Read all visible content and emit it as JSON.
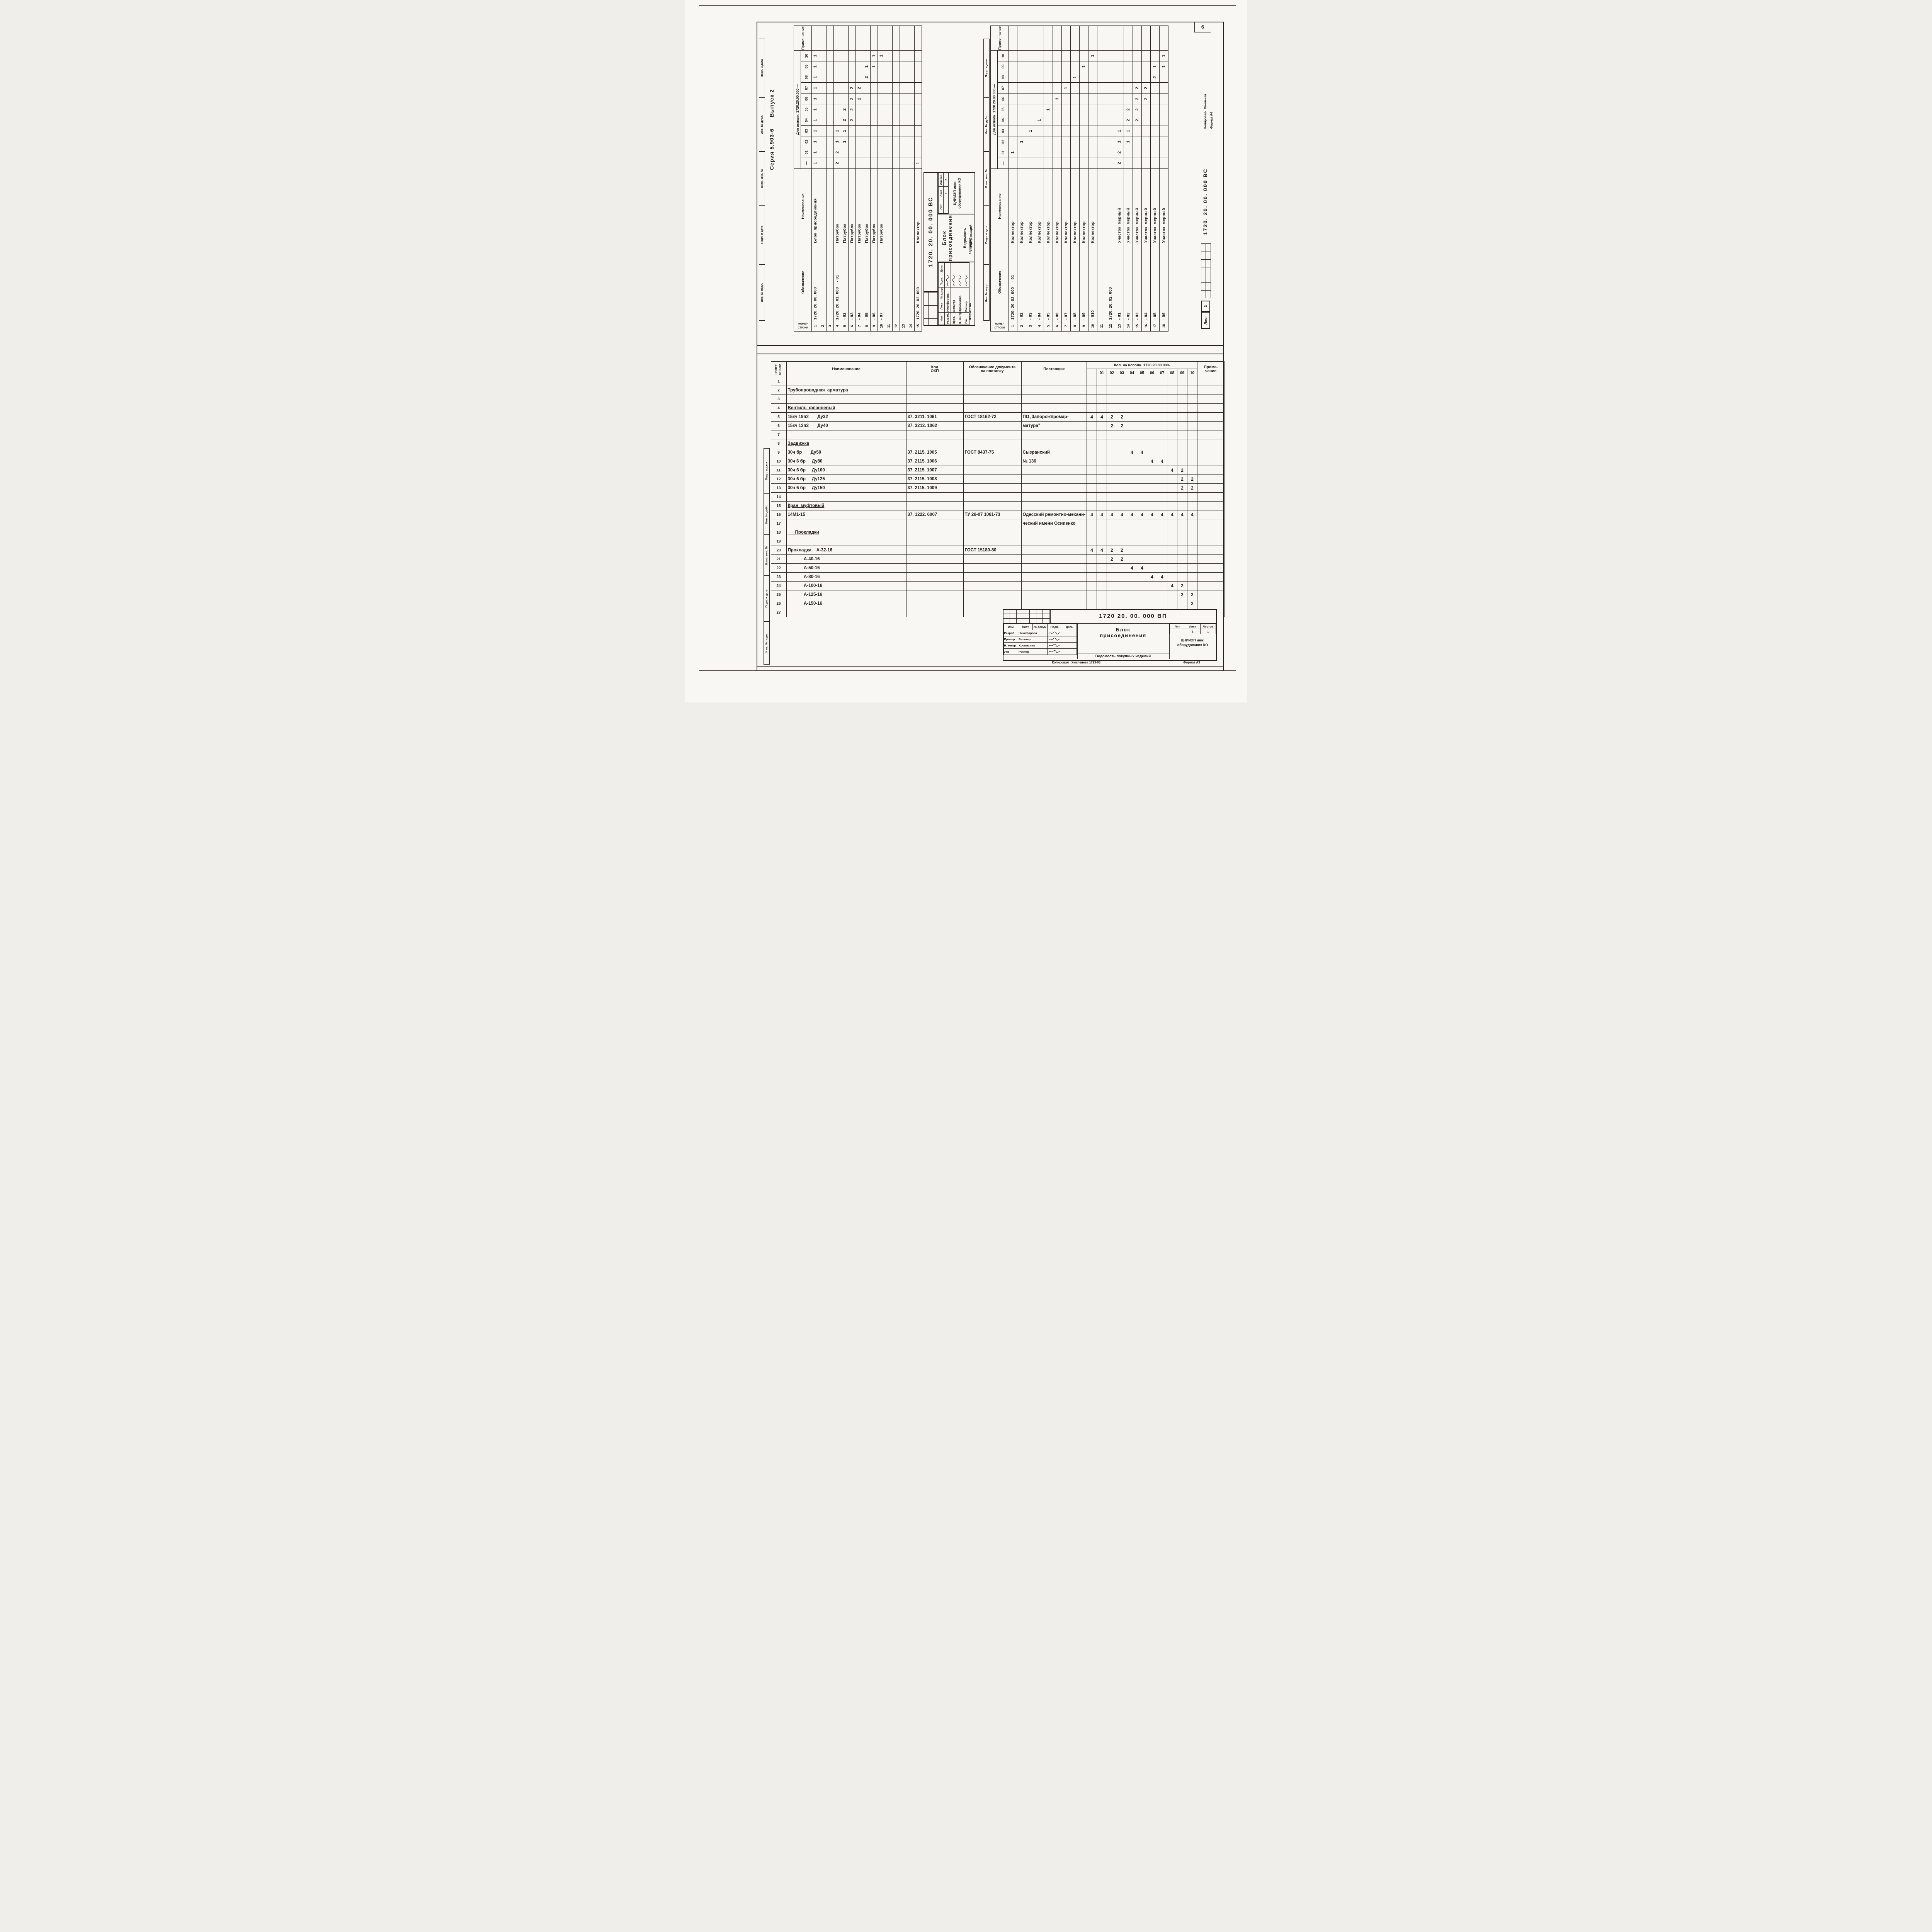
{
  "page": {
    "corner_number": "6",
    "series_header": "Серия 5.903-6      Выпуск 2",
    "margin_labels": [
      "Инв. № подл.",
      "Подп. и дата",
      "Взам. инв. №",
      "Инв. № дубл.",
      "Подп. и дата"
    ]
  },
  "columns_display": [
    "—",
    "01",
    "02",
    "03",
    "04",
    "05",
    "06",
    "07",
    "08",
    "09",
    "10"
  ],
  "sheet1": {
    "header": {
      "num": "НОМЕР\nСТРОКИ",
      "des": "Обозначение",
      "name": "Наименование",
      "exec": "Для исполн. 1720.20.00.000 —",
      "note": "Приме-\nчание"
    },
    "rows": [
      {
        "n": "1",
        "d": "1720. 20. 00. 000",
        "name": "Блок  присоединения",
        "q": {
          "-": "1",
          "01": "1",
          "02": "1",
          "03": "1",
          "04": "1",
          "05": "1",
          "06": "1",
          "07": "1",
          "08": "1",
          "09": "1",
          "10": "1"
        }
      },
      {
        "n": "2"
      },
      {
        "n": "3"
      },
      {
        "n": "4",
        "d": "1720. 20. 01. 000    - 01",
        "name": "Патрубок",
        "q": {
          "-": "2",
          "01": "2",
          "02": "1",
          "03": "1"
        }
      },
      {
        "n": "5",
        "d": "- 02",
        "name": "Патрубок",
        "q": {
          "02": "1",
          "03": "1",
          "04": "2",
          "05": "2"
        }
      },
      {
        "n": "6",
        "d": "- 03",
        "name": "Патрубок",
        "q": {
          "04": "2",
          "05": "2",
          "06": "2",
          "07": "2"
        }
      },
      {
        "n": "7",
        "d": "- 04",
        "name": "Патрубок",
        "q": {
          "06": "2",
          "07": "2"
        }
      },
      {
        "n": "8",
        "d": "- 05",
        "name": "Патрубок",
        "q": {
          "08": "2",
          "09": "1"
        }
      },
      {
        "n": "9",
        "d": "- 06",
        "name": "Патрубок",
        "q": {
          "09": "1",
          "10": "1"
        }
      },
      {
        "n": "10",
        "d": "- 07",
        "name": "Патрубок",
        "q": {
          "10": "1"
        }
      },
      {
        "n": "11"
      },
      {
        "n": "12"
      },
      {
        "n": "13"
      },
      {
        "n": "14"
      },
      {
        "n": "15",
        "d": "1720. 20. 02. 000",
        "name": "Коллектор",
        "q": {
          "-": "1"
        }
      }
    ],
    "stamp": {
      "doc": "1720. 20. 00. 000 ВС",
      "title": "Блок\nприсоединения",
      "subtitle": "Ведомость спецификаций",
      "org1": "ЦНИИЭП инж.",
      "org2": "оборудования КО",
      "lit_h": [
        "Лит.",
        "Лист",
        "Листов"
      ],
      "lit_v": [
        "",
        "1",
        "2"
      ],
      "sig_h": [
        "Изм",
        "Лист",
        "№ докум.",
        "Подп.",
        "Дата"
      ],
      "sigs": [
        [
          "Разраб.",
          "Никифорова"
        ],
        [
          "Пров.",
          "Вельтер"
        ],
        [
          "Н. контр.",
          "Хромихина"
        ],
        [
          "Утв.",
          "Роснер"
        ]
      ],
      "format": "Формат А4",
      "copied": "Копировал·"
    }
  },
  "sheet2": {
    "header": {
      "num": "НОМЕР\nСТРОКИ",
      "des": "Обозначение",
      "name": "Наименование",
      "exec": "Для исполн. 1720 20.00.000 —",
      "note": "Приме-\nчание"
    },
    "rows": [
      {
        "n": "1",
        "d": "1720. 20. 02. 000    - 01",
        "name": "Коллектор",
        "q": {
          "01": "1"
        }
      },
      {
        "n": "2",
        "d": "- 02",
        "name": "Коллектор",
        "q": {
          "02": "1"
        }
      },
      {
        "n": "3",
        "d": "- 03",
        "name": "Коллектор",
        "q": {
          "03": "1"
        }
      },
      {
        "n": "4",
        "d": "- 04",
        "name": "Коллектор",
        "q": {
          "04": "1"
        }
      },
      {
        "n": "5",
        "d": "- 05",
        "name": "Коллектор",
        "q": {
          "05": "1"
        }
      },
      {
        "n": "6",
        "d": "- 06",
        "name": "Коллектор",
        "q": {
          "06": "1"
        }
      },
      {
        "n": "7",
        "d": "- 07",
        "name": "Коллектор",
        "q": {
          "07": "1"
        }
      },
      {
        "n": "8",
        "d": "- 08",
        "name": "Коллектор",
        "q": {
          "08": "1"
        }
      },
      {
        "n": "9",
        "d": "- 09",
        "name": "Коллектор",
        "q": {
          "09": "1"
        }
      },
      {
        "n": "10",
        "d": "- 010",
        "name": "Коллектор",
        "q": {
          "10": "1"
        }
      },
      {
        "n": "11"
      },
      {
        "n": "12",
        "d": "1720. 20. 02. 000"
      },
      {
        "n": "13",
        "d": "- 01",
        "name": "Участок  мерный",
        "q": {
          "-": "2",
          "01": "2",
          "02": "1",
          "03": "1"
        }
      },
      {
        "n": "14",
        "d": "- 02",
        "name": "Участок  мерный",
        "q": {
          "02": "1",
          "03": "1",
          "04": "2",
          "05": "2"
        }
      },
      {
        "n": "15",
        "d": "- 03",
        "name": "Участок  мерный",
        "q": {
          "04": "2",
          "05": "2",
          "06": "2",
          "07": "2"
        }
      },
      {
        "n": "16",
        "d": "- 04",
        "name": "Участок  мерный",
        "q": {
          "06": "2",
          "07": "2"
        }
      },
      {
        "n": "17",
        "d": "- 05",
        "name": "Участок  мерный",
        "q": {
          "08": "2",
          "09": "1"
        }
      },
      {
        "n": "18",
        "d": "- 06",
        "name": "Участок  мерный",
        "q": {
          "09": "1",
          "10": "1"
        }
      }
    ],
    "margin": {
      "list_label": "Лист",
      "list_num": "2",
      "doc": "1720. 20. 00. 000 ВС",
      "copied": "Копировал·  Хмеленен",
      "format": "Формат А4"
    }
  },
  "purchase": {
    "header": {
      "num": "НОМЕР\nСТРОКИ",
      "name": "Наименование",
      "okp": "Код\nОКП",
      "doc": "Обозначение  документа\nна  поставку",
      "sup": "Поставщик",
      "qty": "Кол. на исполн.  1720.20.00.000-",
      "note": "Приме-\nчание"
    },
    "rows": [
      {
        "n": "1"
      },
      {
        "n": "2",
        "name": "Трубопроводная  арматура",
        "u": true
      },
      {
        "n": "3"
      },
      {
        "n": "4",
        "name": "Вентиль  фланцевый",
        "u": true
      },
      {
        "n": "5",
        "name": "15кч 19п2       Ду32",
        "okp": "37. 3211. 1061",
        "doc": "ГОСТ 18162-72",
        "sup": "ПО„Запорожпромар-",
        "q": {
          "-": "4",
          "01": "4",
          "02": "2",
          "03": "2"
        }
      },
      {
        "n": "6",
        "name": "15кч 12п2       Ду40",
        "okp": "37. 3212. 1062",
        "sup": "матура\"",
        "q": {
          "02": "2",
          "03": "2"
        }
      },
      {
        "n": "7"
      },
      {
        "n": "8",
        "name": "Задвижка",
        "u": true
      },
      {
        "n": "9",
        "name": "30ч бр       Ду50",
        "okp": "37. 2115. 1005",
        "doc": "ГОСТ 8437-75",
        "sup": "Сызранский",
        "q": {
          "04": "4",
          "05": "4"
        }
      },
      {
        "n": "10",
        "name": "30ч 6 бр     Ду80",
        "okp": "37. 2115. 1006",
        "sup": "№ 136",
        "q": {
          "06": "4",
          "07": "4"
        }
      },
      {
        "n": "11",
        "name": "30ч 6 бр     Ду100",
        "okp": "37. 2115. 1007",
        "q": {
          "08": "4",
          "09": "2"
        }
      },
      {
        "n": "12",
        "name": "30ч 6 бр     Ду125",
        "okp": "37. 2115. 1008",
        "q": {
          "09": "2",
          "10": "2"
        }
      },
      {
        "n": "13",
        "name": "30ч 6 бр     Ду150",
        "okp": "37. 2115. 1009",
        "q": {
          "09": "2",
          "10": "2"
        }
      },
      {
        "n": "14"
      },
      {
        "n": "15",
        "name": "Кран  муфтовый",
        "u": true
      },
      {
        "n": "16",
        "name": "14М1-15",
        "okp": "37. 1222. 6007",
        "doc": "ТУ 26-07 1061-73",
        "sup": "Одесский ремонтно-механи-",
        "q": {
          "-": "4",
          "01": "4",
          "02": "4",
          "03": "4",
          "04": "4",
          "05": "4",
          "06": "4",
          "07": "4",
          "08": "4",
          "09": "4",
          "10": "4"
        }
      },
      {
        "n": "17",
        "sup": "ческий имени Осипенко"
      },
      {
        "n": "18",
        "name": "      Прокладки",
        "u": true
      },
      {
        "n": "19"
      },
      {
        "n": "20",
        "name": "Прокладка    А-32-16",
        "doc": "ГОСТ 15180-80",
        "q": {
          "-": "4",
          "01": "4",
          "02": "2",
          "03": "2"
        }
      },
      {
        "n": "21",
        "name": "             А-40-16",
        "q": {
          "02": "2",
          "03": "2"
        }
      },
      {
        "n": "22",
        "name": "             А-50-16",
        "q": {
          "04": "4",
          "05": "4"
        }
      },
      {
        "n": "23",
        "name": "             А-80-16",
        "q": {
          "06": "4",
          "07": "4"
        }
      },
      {
        "n": "24",
        "name": "             А-100-16",
        "q": {
          "08": "4",
          "09": "2"
        }
      },
      {
        "n": "25",
        "name": "             А-125-16",
        "q": {
          "09": "2",
          "10": "2"
        }
      },
      {
        "n": "26",
        "name": "             А-150-16",
        "q": {
          "10": "2"
        }
      },
      {
        "n": "27"
      }
    ],
    "stamp": {
      "doc": "1720 20. 00. 000 ВП",
      "title": "Блок\nприсоединения",
      "subtitle": "Ведомость покупных изделий",
      "org1": "ЦНИИЭП инж.",
      "org2": "оборудования КО",
      "lit_h": [
        "Лит",
        "Лист",
        "Листов"
      ],
      "lit_v": [
        "",
        "1",
        "1"
      ],
      "sig_h": [
        "Изм",
        "Лист",
        "№ докум",
        "Подп.",
        "Дата"
      ],
      "sigs": [
        [
          "Разраб",
          "Никифорова"
        ],
        [
          "Провер.",
          "Вельтер"
        ],
        [
          "Н. контр",
          "Хромихина"
        ],
        [
          "Утв",
          "Роснер"
        ]
      ],
      "footer": "Копировал   Хмеленева 1723-03",
      "format": "Формат А3"
    }
  }
}
